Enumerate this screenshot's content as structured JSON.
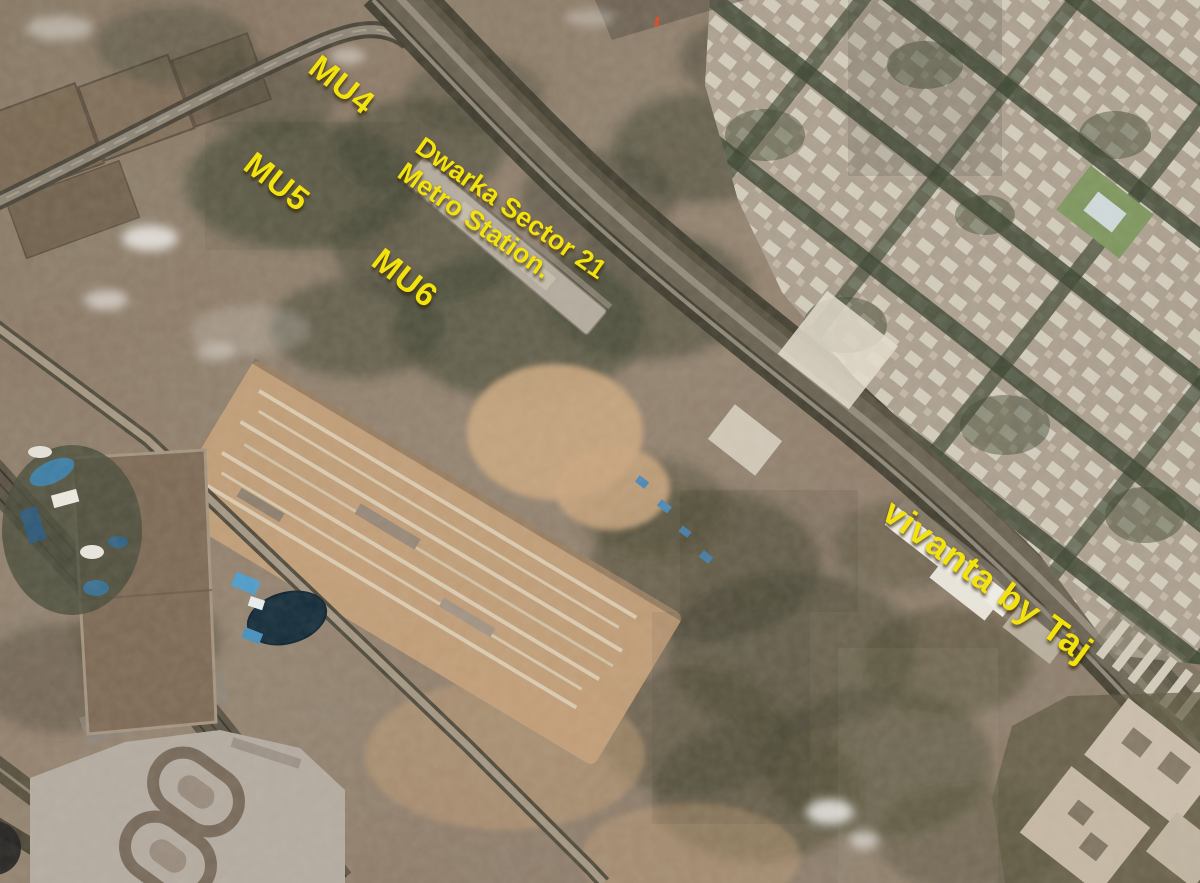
{
  "theme": {
    "label_color": "#f2e20e"
  },
  "map": {
    "imagery_type": "satellite",
    "annotations": {
      "mu4": {
        "text": "MU4"
      },
      "mu5": {
        "text": "MU5"
      },
      "mu6": {
        "text": "MU6"
      },
      "metro_station": {
        "line1": "Dwarka Sector 21",
        "line2": "Metro Station."
      },
      "vivanta": {
        "text": "vivanta by Taj"
      }
    }
  }
}
